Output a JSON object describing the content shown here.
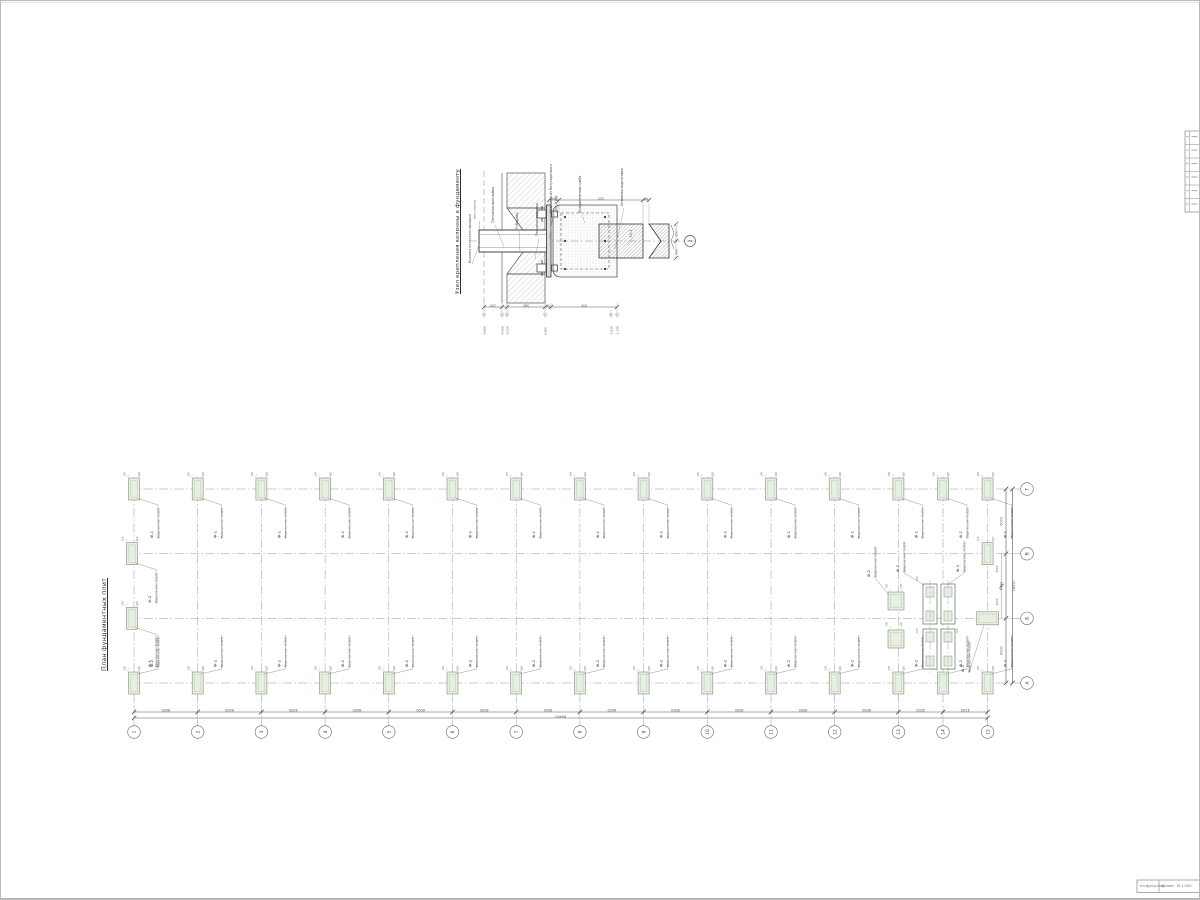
{
  "sheet": {
    "accent_green": "#e7efe3",
    "line_dark": "#3c3c3c",
    "grid_gray": "#9a9a9a"
  },
  "detail": {
    "title": "Узел крепления колонны к фундаменту",
    "column_label": "Колонна из гнутого профиля",
    "column_sub_label": "Низ колонны",
    "top_labels": [
      "Песчаная прослойка",
      "Рубероид",
      "Песчаная подушка",
      "Подливка из безусадочного",
      "ЦПС М300",
      "Фундаментная тумба",
      "Бетонная подготовка"
    ],
    "member_label": "Гн-1",
    "callout": "2",
    "top_dims": [
      "100",
      "925",
      "90"
    ],
    "bottom_dims": [
      "350",
      "580",
      "90",
      "950"
    ],
    "elevations": [
      "-0.600",
      "-0.450",
      "-0.150",
      "0.000",
      "-1.020",
      "-1.150"
    ],
    "end_dims": [
      "150",
      "150"
    ]
  },
  "plan": {
    "title": "План фундаментных плит",
    "col_axes": [
      "1",
      "2",
      "3",
      "4",
      "5",
      "6",
      "7",
      "8",
      "9",
      "10",
      "11",
      "12",
      "13",
      "14",
      "15"
    ],
    "row_axes": [
      "Г",
      "В",
      "Б",
      "А"
    ],
    "bay_dims": [
      "6000",
      "6000",
      "6000",
      "6000",
      "6000",
      "6000",
      "6000",
      "6000",
      "6000",
      "6000",
      "6000",
      "6000",
      "4200",
      "4200"
    ],
    "total_dim": "80400",
    "row_dims": [
      "6000",
      "6000",
      "6000"
    ],
    "mid_dims": [
      "3000",
      "3000"
    ],
    "row_total_dim": "18000",
    "tick_dim": "300",
    "cluster_dims": [
      "500",
      "500",
      "500"
    ],
    "footings": {
      "f1": {
        "name": "Ф-1",
        "note": "Верх на отм. -0.620"
      },
      "f2": {
        "name": "Ф-2",
        "note": "Верх на отм. -0.620"
      },
      "f3": {
        "name": "Ф-3",
        "note": "Верх на отм. -3.420"
      }
    }
  },
  "revision_strip": {
    "rows": 5
  },
  "footer_stamp": {
    "left": "пл.фунд.dwg",
    "right": "Копия · М 1:100"
  }
}
